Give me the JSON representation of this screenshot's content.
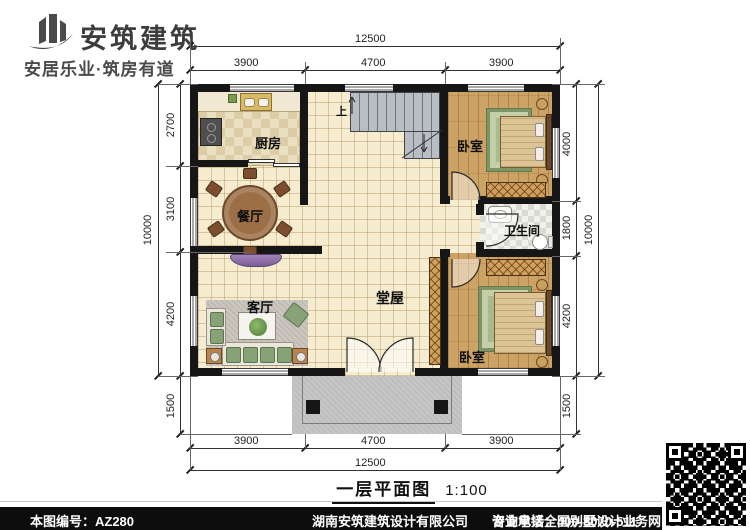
{
  "brand": {
    "name": "安筑建筑",
    "tagline": "安居乐业·筑房有道"
  },
  "plan": {
    "title": "一层平面图",
    "scale": "1:100",
    "stair_up_label": "上",
    "rooms": {
      "kitchen": "厨房",
      "dining": "餐厅",
      "living": "客厅",
      "hall": "堂屋",
      "bath": "卫生间",
      "bedroom_top": "卧室",
      "bedroom_bottom": "卧室"
    },
    "dimensions": {
      "top": {
        "overall": "12500",
        "segments": [
          "3900",
          "4700",
          "3900"
        ]
      },
      "bottom": {
        "overall": "12500",
        "segments": [
          "3900",
          "4700",
          "3900"
        ]
      },
      "left": {
        "overall": "10000",
        "segments": [
          "2700",
          "3100",
          "4200"
        ],
        "porch": "1500"
      },
      "right": {
        "overall": "10000",
        "segments": [
          "4000",
          "1800",
          "4200"
        ],
        "porch": "1500"
      }
    }
  },
  "watermarks": [
    "安筑建筑",
    "hnazjz.com",
    "www.hnazjz.com",
    "安筑建筑",
    "hnazjz.com"
  ],
  "footer": {
    "plan_no": "本图编号：AZ280",
    "company": "湖南安筑建筑设计有限公司",
    "service": "专业承接全国别墅设计业务",
    "phone": "咨询电话：400-8070-511",
    "web_label": "网"
  },
  "colors": {
    "wall": "#161616",
    "floor_tile": "#f6ecd0",
    "wood": "#cda365",
    "porch": "#c6c6c6",
    "sofa_green": "#86a277",
    "tv_purple": "#8f6aa8"
  }
}
